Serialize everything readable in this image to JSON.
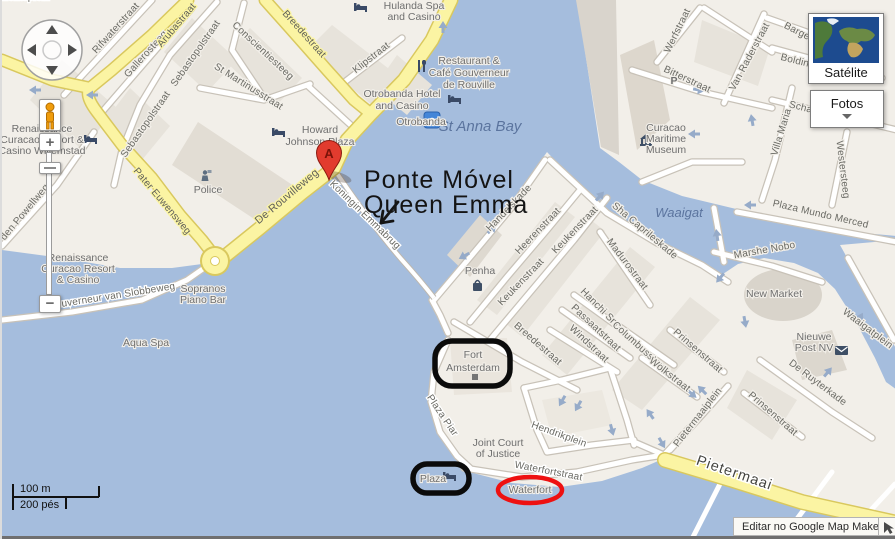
{
  "map": {
    "water": {
      "st_anna_bay": "St Anna Bay",
      "waaigat": "Waaigat"
    },
    "streets": {
      "rifwaterstraat": "Rifwaterstraat",
      "gallerosteeg": "Gallerosteeg",
      "arubastraat": "Arubastraat",
      "sebastopolstraat_1": "Sebastopolstraat",
      "sebastopolstraat_2": "Sebastopolstraat",
      "conscientiesteeg": "Conscientiesteeg",
      "st_martinusstraat": "St Martinusstraat",
      "klipstraat": "Klipstraat",
      "breedestraat_otrobanda": "Breedestraat",
      "de_rouvilleweg": "De Rouvilleweg",
      "pater_euwensweg": "Pater Euwensweg",
      "baden_powellweg": "den Powellweg",
      "gouverneur_van_slobbeweg": "Gouverneur van Slobbeweg",
      "koningin_emmabrug": "Koningin Emmabrug",
      "gouvernementsplein": "Gouvernementsplein",
      "handelskade": "Handelskade",
      "heerenstraat": "Heerenstraat",
      "keukenstraat_1": "Keukenstraat",
      "keukenstraat_2": "Keukenstraat",
      "breedestraat_punda": "Breedestraat",
      "windstraat": "Windstraat",
      "passaatstraat": "Passaatstraat",
      "hanchi_snoa": "Hanchi Snoa",
      "madurostraat": "Madurostraat",
      "sha_caprileskade": "Sha Caprileskade",
      "columbusstraat": "Columbusstraat",
      "wolkstraat": "Wolkstraat",
      "prinsenstraat_1": "Prinsenstraat",
      "prinsenstraat_2": "Prinsenstraat",
      "pietermaaiplein": "Pietermaaiplein",
      "de_ruyterkade": "De Ruyterkade",
      "waaigatplein": "Waaigatplein",
      "hendrikplein": "Hendrikplein",
      "waterfortstraat": "Waterfortstraat",
      "plaza_piar": "Plaza Piar",
      "marshe_nobo": "Marshe Nobo",
      "plaza_mundo_merced": "Plaza Mundo Merced",
      "westersteeg": "Westersteeg",
      "villa_maria": "Villa Maria",
      "van_raderstraat": "Van Raderstraat",
      "werfstraat": "Werfstraat",
      "bitterstraat": "Bitterstraat",
      "barges_fragment": "Barges",
      "bolding_fragment": "Bolding",
      "scha_fragment": "Scha",
      "pietermaai": "Pietermaai"
    },
    "pois": {
      "hulanda_1": "Hulanda Spa",
      "hulanda_2": "and Casino",
      "restaurant_1": "Restaurant &",
      "restaurant_2": "Café Gouverneur",
      "restaurant_3": "de Rouville",
      "otrobanda_hotel_1": "Otrobanda Hotel",
      "otrobanda_hotel_2": "and Casino",
      "howard_1": "Howard",
      "howard_2": "Johnson Plaza",
      "otrobanda": "Otrobanda",
      "renaissance1_1": "Renaissance",
      "renaissance1_2": "Curacao Resort &",
      "renaissance1_3": "Casino Willemstad",
      "police": "Police",
      "renaissance2_1": "Renaissance",
      "renaissance2_2": "Curacao Resort",
      "renaissance2_3": "& Casino",
      "sopranos_1": "Sopranos",
      "sopranos_2": "Piano Bar",
      "aqua_spa": "Aqua Spa",
      "penha": "Penha",
      "maritime_1": "Curacao",
      "maritime_2": "Maritime",
      "maritime_3": "Museum",
      "new_market": "New Market",
      "post_1": "Nieuwe",
      "post_2": "Post NV",
      "court_1": "Joint Court",
      "court_2": "of Justice",
      "fort_1": "Fort",
      "fort_2": "Amsterdam",
      "plaza": "Plaza",
      "waterfort": "Waterfort",
      "parking": "P"
    },
    "marker_a": "A",
    "annotation": {
      "line1": "Ponte Móvel",
      "line2": "Queen Emma"
    }
  },
  "controls": {
    "satellite": "Satélite",
    "photos": "Fotos",
    "zoom_in": "+",
    "zoom_out": "−"
  },
  "scale": {
    "metric": "100 m",
    "imperial": "200 pés"
  },
  "footer": {
    "edit": "Editar no Google Map Maker"
  },
  "colors": {
    "water": "#a5bddd",
    "land": "#f2efe9",
    "block": "#e7e3db",
    "yellow_road": "#fbf4a3",
    "annotation_black": "#0b0b0b",
    "annotation_red": "#ee1111",
    "marker_red": "#e23b2e"
  }
}
